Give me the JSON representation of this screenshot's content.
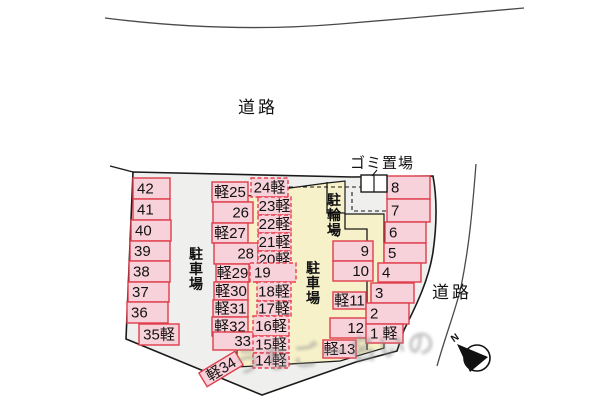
{
  "labels": {
    "road_top": "道路",
    "road_right": "道路",
    "garbage": "ゴミ置場",
    "parking_left": "駐車場",
    "parking_right": "駐車場",
    "bicycle": "駐輪場",
    "north": "N",
    "watermark": "うちごー名いの"
  },
  "colors": {
    "space_fill": "#f8d2da",
    "space_border_solid": "#df3d4c",
    "space_border_dashed": "#e8404e",
    "site_fill": "#efefed",
    "building_area_fill": "#f6f1c8",
    "line": "#1a1a1a",
    "road_line": "#4a4a4a"
  },
  "area_labels": [
    {
      "id": "road-top",
      "text": "道路",
      "x": 238,
      "y": 113,
      "size": 17,
      "spacing": 3
    },
    {
      "id": "road-right",
      "text": "道路",
      "x": 432,
      "y": 298,
      "size": 17,
      "spacing": 3
    },
    {
      "id": "garbage",
      "text": "ゴミ置場",
      "x": 350,
      "y": 168,
      "size": 15,
      "spacing": 1
    },
    {
      "id": "parking-left",
      "text": "駐車場",
      "x": 196,
      "y": 259,
      "size": 14,
      "vertical": true,
      "bold": true
    },
    {
      "id": "parking-right",
      "text": "駐車場",
      "x": 313,
      "y": 273,
      "size": 14,
      "vertical": true,
      "bold": true
    },
    {
      "id": "bicycle",
      "text": "駐輪場",
      "x": 334,
      "y": 205,
      "size": 14,
      "vertical": true,
      "bold": true
    }
  ],
  "spaces": [
    {
      "label": "42",
      "x": 133,
      "y": 178,
      "w": 37,
      "h": 21,
      "border": "solid",
      "align": "left"
    },
    {
      "label": "41",
      "x": 133,
      "y": 199,
      "w": 37,
      "h": 21,
      "border": "solid",
      "align": "left"
    },
    {
      "label": "40",
      "x": 131,
      "y": 220,
      "w": 40,
      "h": 21,
      "border": "solid",
      "align": "left"
    },
    {
      "label": "39",
      "x": 130,
      "y": 241,
      "w": 40,
      "h": 20,
      "border": "solid",
      "align": "left"
    },
    {
      "label": "38",
      "x": 129,
      "y": 261,
      "w": 41,
      "h": 21,
      "border": "solid",
      "align": "left"
    },
    {
      "label": "37",
      "x": 128,
      "y": 282,
      "w": 41,
      "h": 20,
      "border": "solid",
      "align": "left"
    },
    {
      "label": "36",
      "x": 127,
      "y": 302,
      "w": 41,
      "h": 21,
      "border": "solid",
      "align": "left"
    },
    {
      "label": "35軽",
      "x": 139,
      "y": 324,
      "w": 40,
      "h": 21,
      "border": "solid",
      "align": "center"
    },
    {
      "label": "軽25",
      "x": 212,
      "y": 182,
      "w": 36,
      "h": 20,
      "border": "solid",
      "align": "center"
    },
    {
      "label": "26",
      "x": 213,
      "y": 202,
      "w": 40,
      "h": 21,
      "border": "solid",
      "align": "right"
    },
    {
      "label": "軽27",
      "x": 212,
      "y": 223,
      "w": 36,
      "h": 20,
      "border": "solid",
      "align": "center"
    },
    {
      "label": "28",
      "x": 214,
      "y": 243,
      "w": 44,
      "h": 21,
      "border": "solid",
      "align": "right"
    },
    {
      "label": "軽29",
      "x": 216,
      "y": 264,
      "w": 33,
      "h": 18,
      "border": "solid",
      "align": "center"
    },
    {
      "label": "軽30",
      "x": 214,
      "y": 282,
      "w": 34,
      "h": 18,
      "border": "solid",
      "align": "center"
    },
    {
      "label": "軽31",
      "x": 213,
      "y": 300,
      "w": 35,
      "h": 17,
      "border": "solid",
      "align": "center"
    },
    {
      "label": "軽32",
      "x": 212,
      "y": 317,
      "w": 36,
      "h": 19,
      "border": "solid",
      "align": "center"
    },
    {
      "label": "33",
      "x": 213,
      "y": 332,
      "w": 42,
      "h": 18,
      "border": "solid",
      "align": "right"
    },
    {
      "label": "軽34",
      "x": 200,
      "y": 361,
      "w": 42,
      "h": 16,
      "border": "solid",
      "align": "center",
      "rot": -31
    },
    {
      "label": "24軽",
      "x": 251,
      "y": 178,
      "w": 37,
      "h": 19,
      "border": "dashed",
      "align": "center"
    },
    {
      "label": "23軽",
      "x": 258,
      "y": 197,
      "w": 33,
      "h": 18,
      "border": "dashed",
      "align": "center"
    },
    {
      "label": "22軽",
      "x": 258,
      "y": 215,
      "w": 33,
      "h": 18,
      "border": "dashed",
      "align": "center"
    },
    {
      "label": "21軽",
      "x": 258,
      "y": 233,
      "w": 33,
      "h": 18,
      "border": "dashed",
      "align": "center"
    },
    {
      "label": "20軽",
      "x": 258,
      "y": 251,
      "w": 33,
      "h": 17,
      "border": "dashed",
      "align": "center"
    },
    {
      "label": "19",
      "x": 250,
      "y": 263,
      "w": 46,
      "h": 19,
      "border": "dashed",
      "align": "left"
    },
    {
      "label": "18軽",
      "x": 257,
      "y": 282,
      "w": 34,
      "h": 19,
      "border": "dashed",
      "align": "center"
    },
    {
      "label": "17軽",
      "x": 257,
      "y": 301,
      "w": 34,
      "h": 15,
      "border": "dashed",
      "align": "center"
    },
    {
      "label": "16軽",
      "x": 253,
      "y": 316,
      "w": 36,
      "h": 20,
      "border": "dashed",
      "align": "center"
    },
    {
      "label": "15軽",
      "x": 253,
      "y": 336,
      "w": 36,
      "h": 17,
      "border": "dashed",
      "align": "center"
    },
    {
      "label": "14軽",
      "x": 253,
      "y": 353,
      "w": 36,
      "h": 15,
      "border": "dashed",
      "align": "center"
    },
    {
      "label": "9",
      "x": 333,
      "y": 241,
      "w": 40,
      "h": 20,
      "border": "solid",
      "align": "right"
    },
    {
      "label": "10",
      "x": 333,
      "y": 261,
      "w": 40,
      "h": 20,
      "border": "solid",
      "align": "right"
    },
    {
      "label": "軽11",
      "x": 333,
      "y": 292,
      "w": 33,
      "h": 17,
      "border": "solid",
      "align": "center"
    },
    {
      "label": "12",
      "x": 330,
      "y": 318,
      "w": 38,
      "h": 20,
      "border": "solid",
      "align": "right"
    },
    {
      "label": "軽13",
      "x": 323,
      "y": 340,
      "w": 33,
      "h": 18,
      "border": "solid",
      "align": "center"
    },
    {
      "label": "8",
      "x": 387,
      "y": 176,
      "w": 43,
      "h": 23,
      "border": "solid",
      "align": "left"
    },
    {
      "label": "7",
      "x": 387,
      "y": 199,
      "w": 43,
      "h": 23,
      "border": "solid",
      "align": "left"
    },
    {
      "label": "6",
      "x": 385,
      "y": 222,
      "w": 41,
      "h": 21,
      "border": "solid",
      "align": "left"
    },
    {
      "label": "5",
      "x": 384,
      "y": 243,
      "w": 42,
      "h": 20,
      "border": "solid",
      "align": "left"
    },
    {
      "label": "4",
      "x": 378,
      "y": 263,
      "w": 43,
      "h": 19,
      "border": "solid",
      "align": "left"
    },
    {
      "label": "3",
      "x": 371,
      "y": 283,
      "w": 43,
      "h": 20,
      "border": "solid",
      "align": "left"
    },
    {
      "label": "2",
      "x": 366,
      "y": 303,
      "w": 43,
      "h": 21,
      "border": "solid",
      "align": "left"
    },
    {
      "label": "1 軽",
      "x": 366,
      "y": 324,
      "w": 37,
      "h": 19,
      "border": "solid",
      "align": "left"
    }
  ]
}
